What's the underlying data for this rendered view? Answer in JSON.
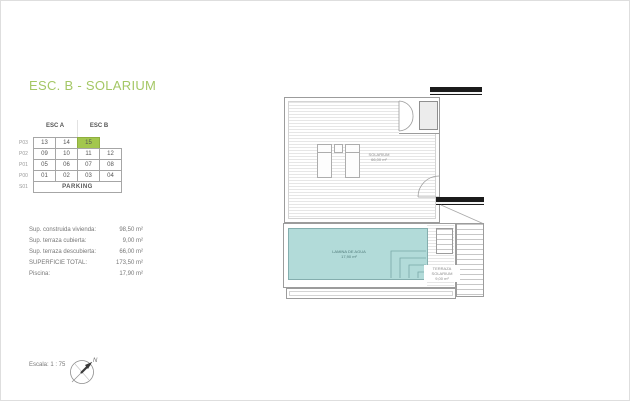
{
  "page": {
    "title": "ESC. B - SOLARIUM"
  },
  "units_table": {
    "col_groups": [
      "ESC A",
      "ESC B"
    ],
    "highlighted_unit": "15",
    "highlight_color": "#a3c74e",
    "rows": [
      {
        "label": "P03",
        "cells": [
          "13",
          "14",
          "15"
        ]
      },
      {
        "label": "P02",
        "cells": [
          "09",
          "10",
          "11",
          "12"
        ]
      },
      {
        "label": "P01",
        "cells": [
          "05",
          "06",
          "07",
          "08"
        ]
      },
      {
        "label": "P00",
        "cells": [
          "01",
          "02",
          "03",
          "04"
        ]
      },
      {
        "label": "S01",
        "cells": [
          "PARKING"
        ]
      }
    ]
  },
  "measurements": {
    "rows": [
      {
        "label": "Sup. construida vivienda:",
        "value": "98,50 m²"
      },
      {
        "label": "Sup. terraza cubierta:",
        "value": "9,00 m²"
      },
      {
        "label": "Sup. terraza descubierta:",
        "value": "66,00 m²"
      },
      {
        "label": "SUPERFICIE TOTAL:",
        "value": "173,50 m²"
      },
      {
        "label": "Piscina:",
        "value": "17,90 m²"
      }
    ]
  },
  "plan": {
    "solarium_label": {
      "line1": "SOLARIUM",
      "line2": "66,00 m²"
    },
    "pool_label": {
      "line1": "LAMINA DE AGUA",
      "line2": "17,90 m²"
    },
    "terrace_label": {
      "line1": "TERRAZA SOLARIUM",
      "line2": "9,00 m²"
    },
    "pool_color": "#b2dbd9"
  },
  "footer": {
    "scale_label": "Escala: 1 : 75",
    "compass_north": "N"
  },
  "colors": {
    "accent_green": "#a4c765",
    "highlight_green": "#a3c74e",
    "pool_teal": "#b2dbd9",
    "beam_black": "#1b1b1b"
  }
}
